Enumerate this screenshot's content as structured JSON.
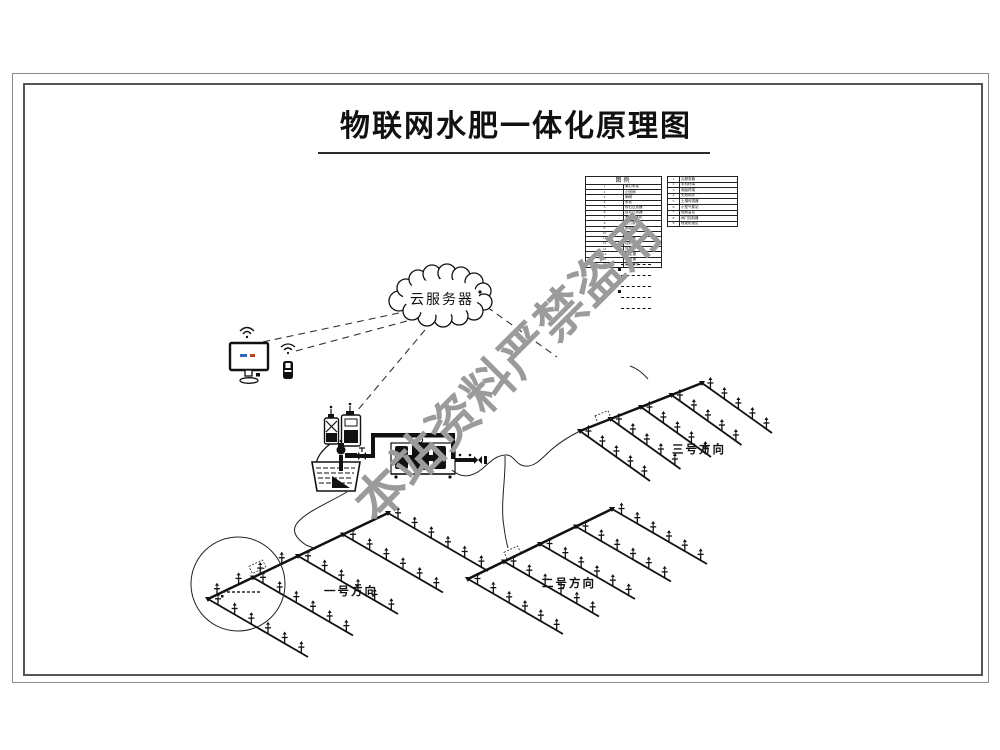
{
  "title": "物联网水肥一体化原理图",
  "watermark": "本站资料严禁盗用",
  "cloud_label": "云服务器",
  "legend": {
    "header": "图例",
    "left_rows": [
      [
        "1",
        "离心水泵"
      ],
      [
        "2",
        "止回阀"
      ],
      [
        "3",
        "闸阀"
      ],
      [
        "4",
        "水表"
      ],
      [
        "5",
        "砂石过滤器"
      ],
      [
        "6",
        "叠片过滤器"
      ],
      [
        "7",
        "水肥一体机"
      ],
      [
        "8",
        "压力表"
      ],
      [
        "9",
        "电磁阀"
      ],
      [
        "10",
        "球阀"
      ],
      [
        "11",
        "肥料桶"
      ],
      [
        "12",
        "控制柜"
      ],
      [
        "13",
        "流量计"
      ],
      [
        "14",
        "PE主管"
      ],
      [
        "15",
        "PE支管"
      ],
      [
        "16",
        "摇臂喷头"
      ]
    ],
    "right_rows": [
      [
        "1",
        "云服务器"
      ],
      [
        "2",
        "手机终端"
      ],
      [
        "3",
        "电脑终端"
      ],
      [
        "4",
        "无线网关"
      ],
      [
        "5",
        "土壤传感器"
      ],
      [
        "6",
        "小型气象站"
      ],
      [
        "7",
        "视频监控"
      ],
      [
        "8",
        "阀门控制器"
      ],
      [
        "9",
        "喷灌轮灌区"
      ]
    ]
  },
  "directions": {
    "d1": "一号方向",
    "d2": "二号方向",
    "d3": "三号方向"
  }
}
